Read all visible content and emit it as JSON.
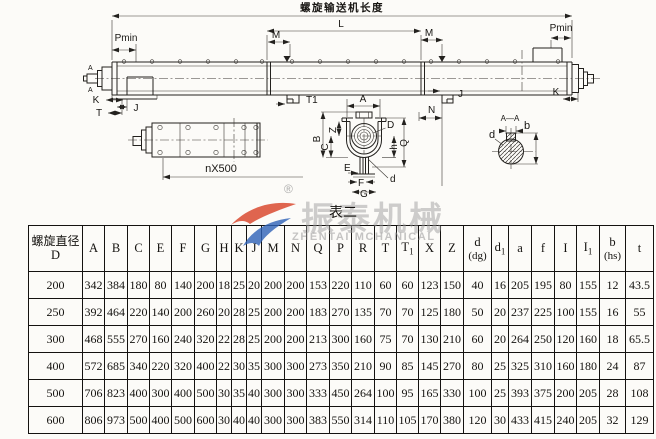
{
  "drawing": {
    "title": "螺旋输送机长度",
    "dims": {
      "Pmin": "Pmin",
      "L": "L",
      "M": "M",
      "K": "K",
      "J": "J",
      "T": "T",
      "T1": "T1",
      "A": "A",
      "N": "N"
    },
    "nx500": "nX500",
    "section": {
      "B": "B",
      "C": "C",
      "Z": "Z",
      "Q": "Q",
      "h": "h",
      "D": "D",
      "E": "E",
      "F": "F",
      "G": "G",
      "d": "d"
    },
    "shaft": {
      "title": "A—A",
      "b": "b",
      "d": "d"
    }
  },
  "watermark": {
    "reg": "®",
    "cn": "振泰机械",
    "en": "ZHENTAI MCHANICAL"
  },
  "table": {
    "caption": "表二",
    "diameter_header": {
      "line1": "螺旋直径",
      "line2": "D"
    },
    "columns": [
      {
        "t": "A"
      },
      {
        "t": "B"
      },
      {
        "t": "C"
      },
      {
        "t": "E"
      },
      {
        "t": "F"
      },
      {
        "t": "G"
      },
      {
        "t": "H"
      },
      {
        "t": "K"
      },
      {
        "t": "J"
      },
      {
        "t": "M"
      },
      {
        "t": "N"
      },
      {
        "t": "Q"
      },
      {
        "t": "P"
      },
      {
        "t": "R"
      },
      {
        "t": "T"
      },
      {
        "t": "T",
        "s": "1"
      },
      {
        "t": "X"
      },
      {
        "t": "Z"
      },
      {
        "t": "d",
        "u": "(dg)"
      },
      {
        "t": "d",
        "s": "1"
      },
      {
        "t": "a"
      },
      {
        "t": "f"
      },
      {
        "t": "I"
      },
      {
        "t": "I",
        "s": "1"
      },
      {
        "t": "b",
        "u": "(hs)"
      },
      {
        "t": "t"
      }
    ],
    "rows": [
      {
        "d": "200",
        "v": [
          "342",
          "384",
          "180",
          "80",
          "140",
          "200",
          "18",
          "25",
          "20",
          "200",
          "200",
          "153",
          "220",
          "110",
          "60",
          "60",
          "123",
          "150",
          "40",
          "16",
          "205",
          "195",
          "80",
          "155",
          "12",
          "43.5"
        ]
      },
      {
        "d": "250",
        "v": [
          "392",
          "464",
          "220",
          "140",
          "200",
          "260",
          "20",
          "28",
          "25",
          "200",
          "200",
          "183",
          "270",
          "135",
          "70",
          "70",
          "125",
          "180",
          "50",
          "20",
          "237",
          "225",
          "100",
          "155",
          "16",
          "55"
        ]
      },
      {
        "d": "300",
        "v": [
          "468",
          "555",
          "270",
          "160",
          "240",
          "320",
          "22",
          "28",
          "25",
          "200",
          "200",
          "213",
          "300",
          "160",
          "75",
          "70",
          "130",
          "210",
          "60",
          "20",
          "264",
          "250",
          "120",
          "160",
          "18",
          "65.5"
        ]
      },
      {
        "d": "400",
        "v": [
          "572",
          "685",
          "340",
          "220",
          "320",
          "400",
          "22",
          "30",
          "35",
          "300",
          "300",
          "273",
          "350",
          "210",
          "90",
          "85",
          "145",
          "270",
          "80",
          "25",
          "325",
          "310",
          "160",
          "180",
          "24",
          "87"
        ]
      },
      {
        "d": "500",
        "v": [
          "706",
          "823",
          "400",
          "300",
          "400",
          "500",
          "30",
          "35",
          "40",
          "300",
          "300",
          "333",
          "450",
          "264",
          "100",
          "95",
          "165",
          "330",
          "100",
          "25",
          "393",
          "375",
          "200",
          "205",
          "28",
          "108"
        ]
      },
      {
        "d": "600",
        "v": [
          "806",
          "973",
          "500",
          "400",
          "500",
          "600",
          "30",
          "40",
          "40",
          "300",
          "300",
          "383",
          "550",
          "314",
          "110",
          "105",
          "170",
          "380",
          "120",
          "30",
          "433",
          "415",
          "240",
          "205",
          "32",
          "129"
        ]
      }
    ]
  }
}
